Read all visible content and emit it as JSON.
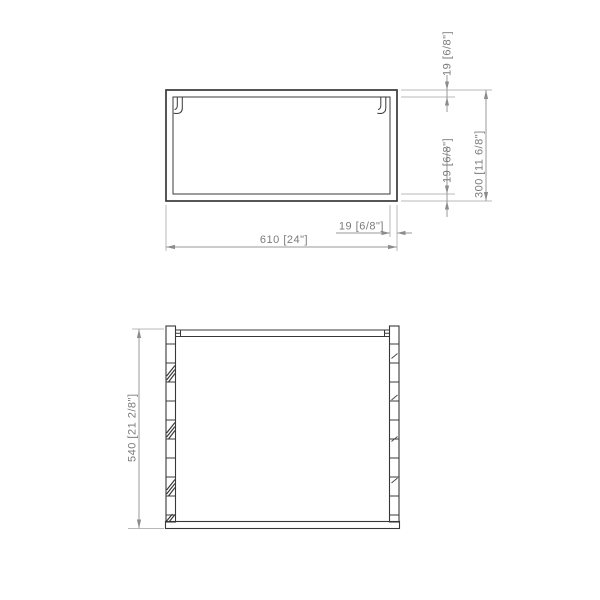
{
  "colors": {
    "background": "#ffffff",
    "object_line": "#383838",
    "dimension_line": "#9a9a9a",
    "extension_line": "#b8b8b8",
    "arrow": "#8c8c8c",
    "text": "#7b7b7b"
  },
  "views": {
    "top_view": {
      "dimensions": {
        "width": "610 [24\"]",
        "depth": "300 [11 6/8\"]",
        "back_panel_thickness": "19 [6/8\"]",
        "front_panel_thickness": "19 [6/8\"]",
        "side_panel_thickness": "19 [6/8\"]"
      }
    },
    "front_view": {
      "dimensions": {
        "height": "540 [21 2/8\"]"
      }
    }
  }
}
